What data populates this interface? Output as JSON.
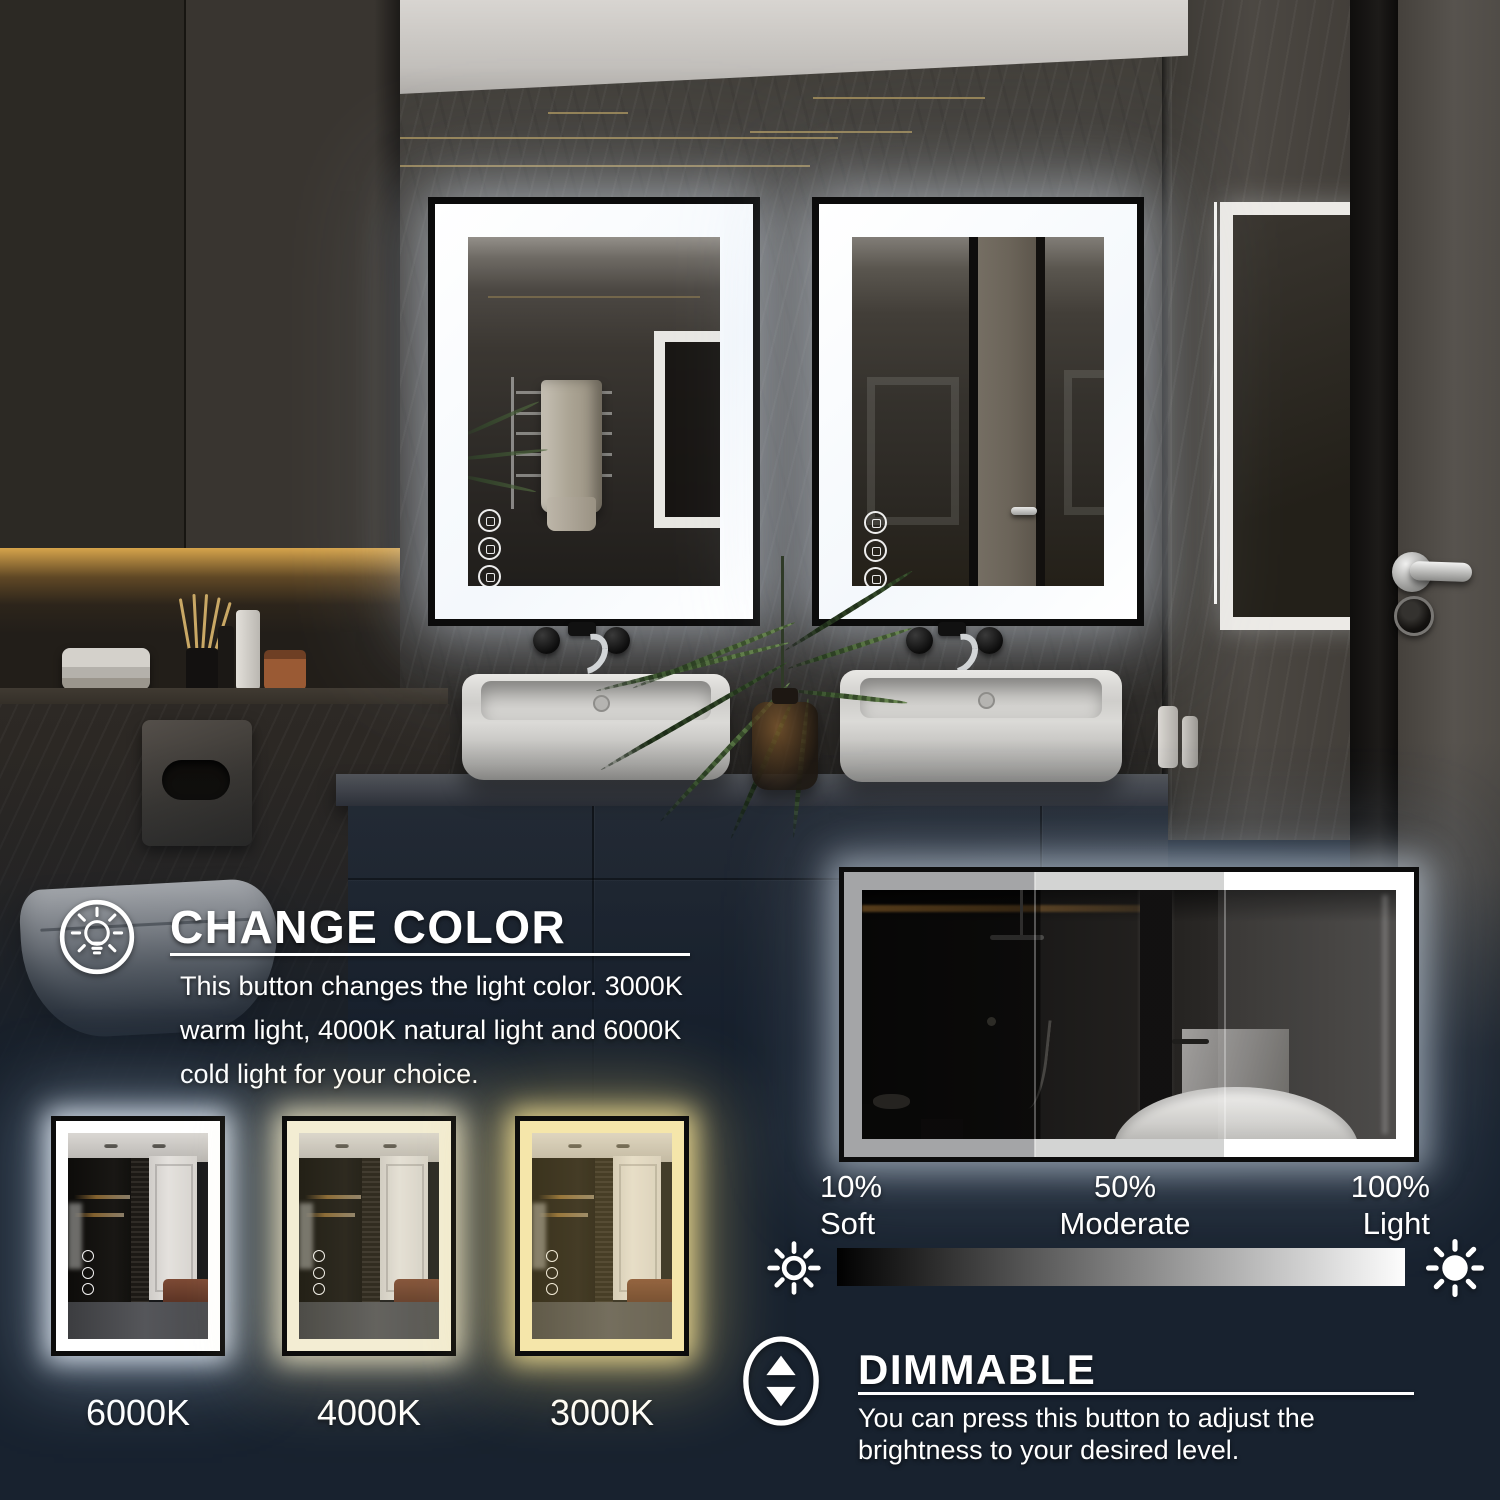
{
  "colors": {
    "background": "#18222f",
    "led_white": "#ffffff",
    "frame_black": "#0c0c0c",
    "brightness_gradient_from": "#000000",
    "brightness_gradient_to": "#ffffff"
  },
  "change_color": {
    "icon": "lightbulb-icon",
    "title": "CHANGE COLOR",
    "description": "This button changes the light color. 3000K warm light, 4000K natural light and 6000K cold light for your choice."
  },
  "color_temps": {
    "options": [
      {
        "label": "6000K",
        "band_color": "#ffffff"
      },
      {
        "label": "4000K",
        "band_color": "#f3edd3"
      },
      {
        "label": "3000K",
        "band_color": "#f5e6aa"
      }
    ]
  },
  "brightness": {
    "left_icon": "sun-dim-icon",
    "right_icon": "sun-bright-icon",
    "levels": [
      {
        "percent": "10%",
        "label": "Soft"
      },
      {
        "percent": "50%",
        "label": "Moderate"
      },
      {
        "percent": "100%",
        "label": "Light"
      }
    ]
  },
  "dimmable": {
    "icon": "dim-adjust-icon",
    "title": "DIMMABLE",
    "description": "You can press this button to adjust the brightness to your desired level."
  }
}
